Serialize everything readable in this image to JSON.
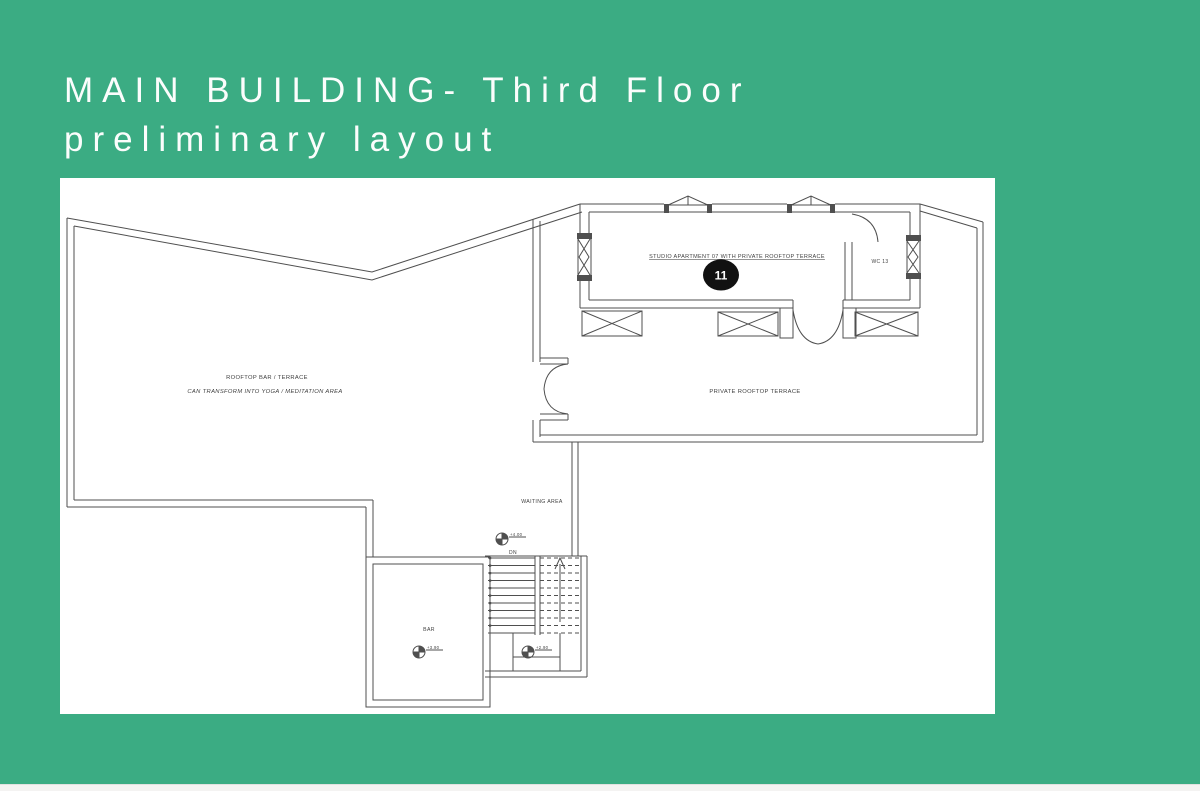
{
  "title": {
    "line1": "MAIN BUILDING- Third Floor",
    "line2": "preliminary layout"
  },
  "colors": {
    "background_green": "#3bac83",
    "panel_white": "#ffffff",
    "drawing_line": "#4f4f4f",
    "unit_badge": "#111111"
  },
  "plan": {
    "labels": {
      "studio": "STUDIO APARTMENT 07 WITH PRIVATE ROOFTOP TERRACE",
      "unit": "11",
      "wc": "WC 13",
      "rooftop_bar": "ROOFTOP BAR / TERRACE",
      "rooftop_bar_note": "CAN TRANSFORM INTO YOGA / MEDITATION AREA",
      "private_terrace": "PRIVATE ROOFTOP TERRACE",
      "waiting": "WAITING AREA",
      "bar": "BAR",
      "dn": "DN"
    },
    "levels": {
      "waiting": "+4.00",
      "bar": "+3.90",
      "landing": "+2.90"
    }
  }
}
